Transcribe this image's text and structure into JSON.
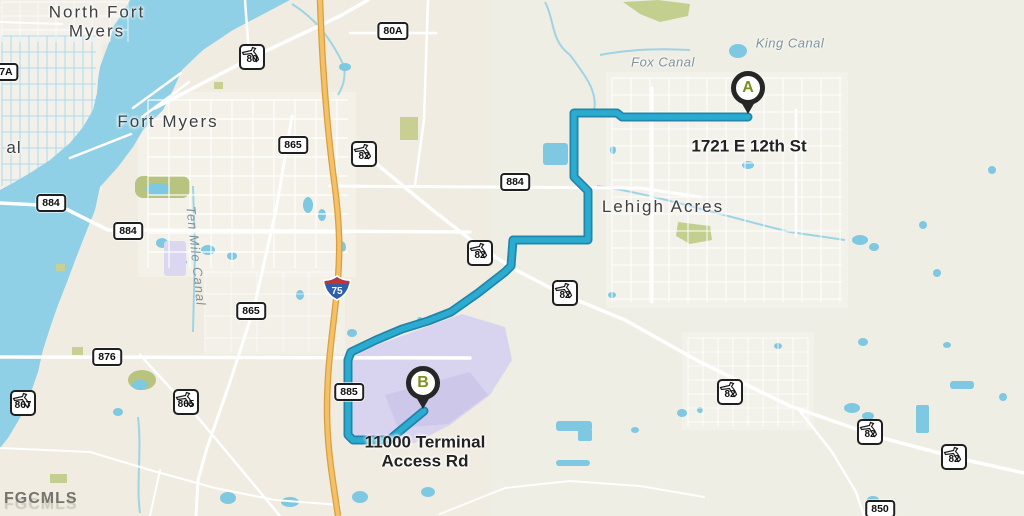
{
  "watermark": "FGCMLS",
  "cities": [
    {
      "name": "North Fort Myers"
    },
    {
      "name": "Fort Myers"
    },
    {
      "name": "Lehigh Acres"
    }
  ],
  "waterways": [
    {
      "name": "Fox Canal"
    },
    {
      "name": "King Canal"
    },
    {
      "name": "Ten Mile Canal"
    },
    {
      "name": "al"
    }
  ],
  "markers": [
    {
      "letter": "A",
      "address": "1721 E 12th St"
    },
    {
      "letter": "B",
      "address": "11000 Terminal Access Rd"
    }
  ],
  "shields": {
    "interstate": [
      {
        "num": "75"
      }
    ],
    "state_rect": [
      {
        "num": "80A"
      },
      {
        "num": "67A"
      },
      {
        "num": "865"
      },
      {
        "num": "884"
      },
      {
        "num": "884"
      },
      {
        "num": "884"
      },
      {
        "num": "865"
      },
      {
        "num": "876"
      },
      {
        "num": "885"
      },
      {
        "num": "850"
      }
    ],
    "state_florida": [
      {
        "num": "80"
      },
      {
        "num": "82"
      },
      {
        "num": "82"
      },
      {
        "num": "82"
      },
      {
        "num": "82"
      },
      {
        "num": "82"
      },
      {
        "num": "82"
      },
      {
        "num": "867"
      },
      {
        "num": "865"
      }
    ]
  },
  "colors": {
    "land": "#f0ece2",
    "water": "#8fd0e6",
    "route": "#2cabd0",
    "airport_area": "#d8d4ef",
    "interstate_road": "#f4c068",
    "marker_letter": "#7d8f1c",
    "interstate_blue": "#2f5fa8",
    "interstate_red": "#bf3434"
  }
}
